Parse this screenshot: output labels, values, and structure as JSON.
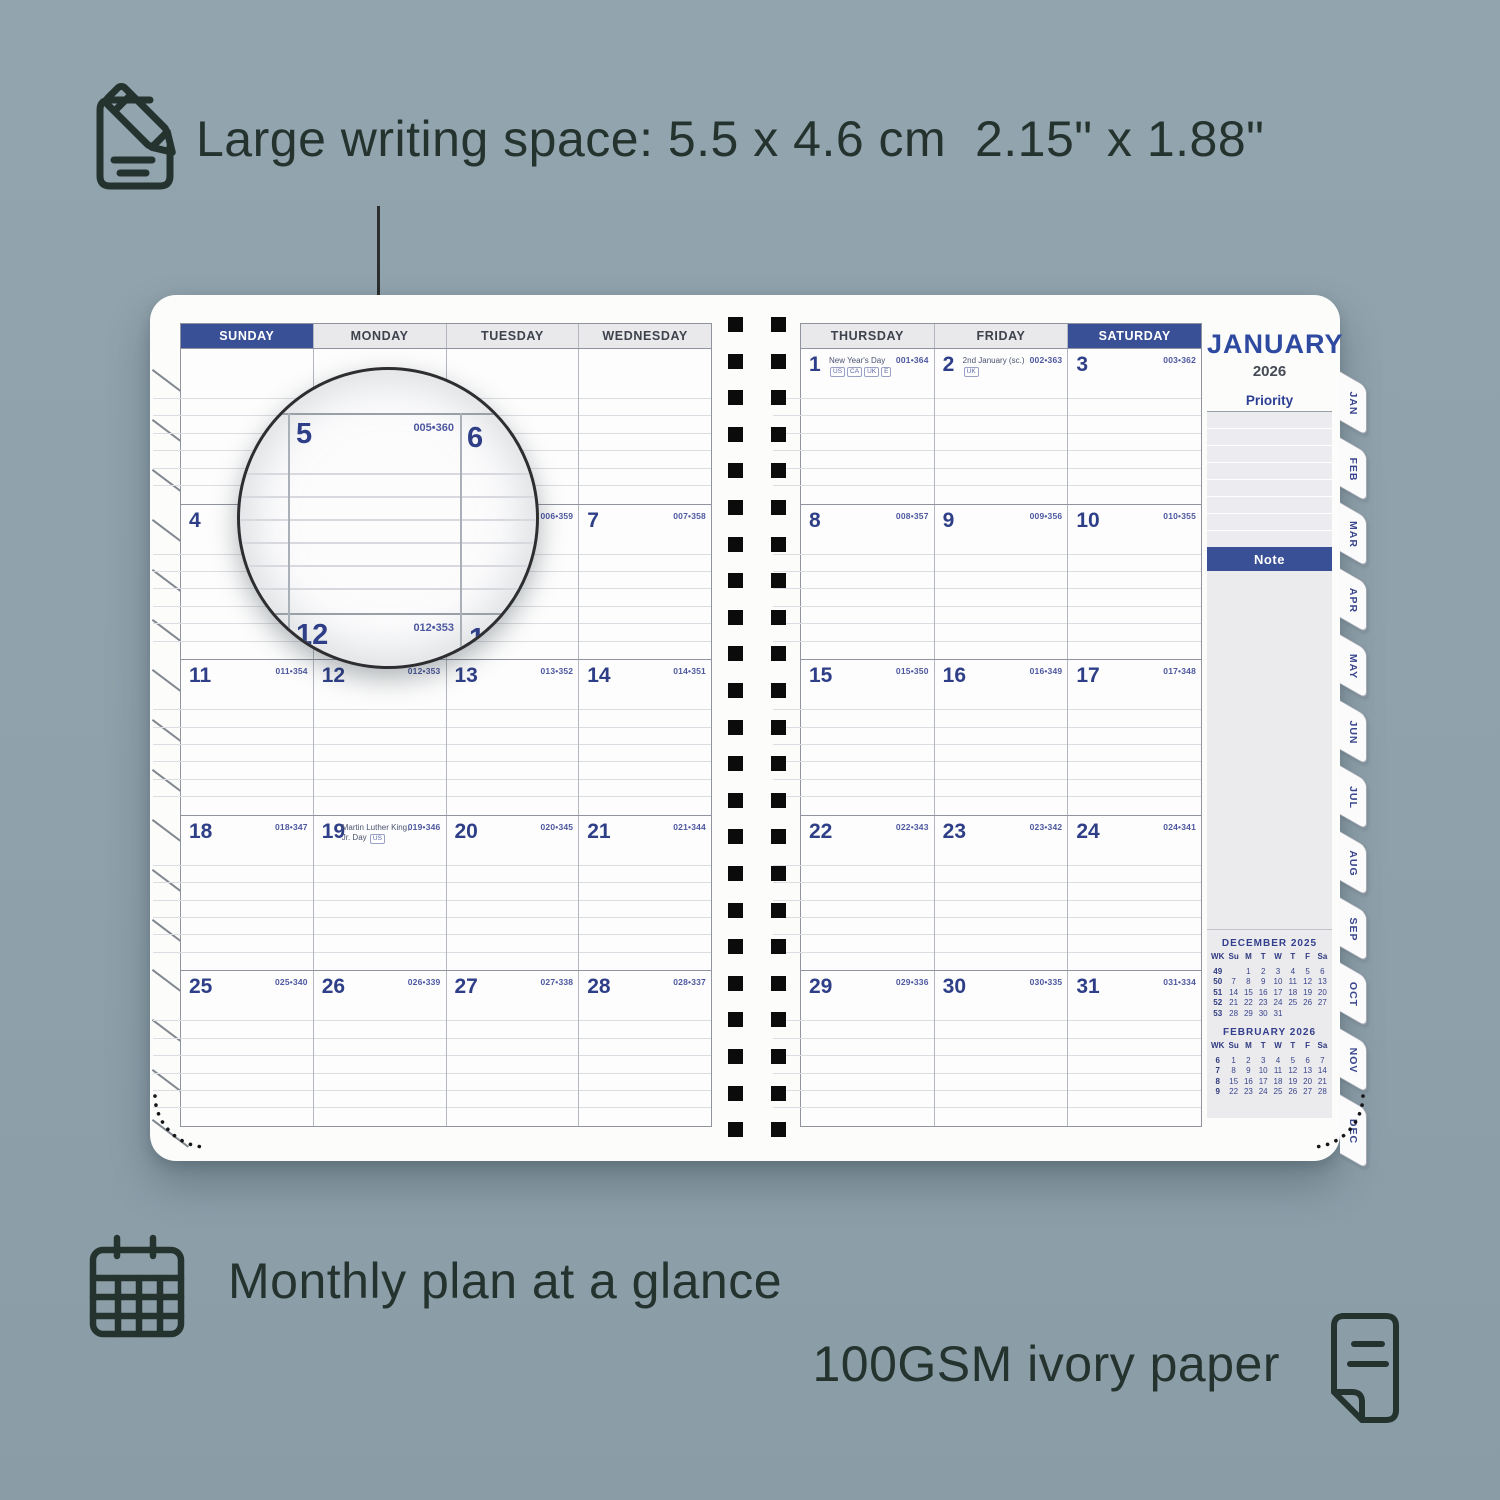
{
  "features": {
    "writing_space": "Large writing space: 5.5 x 4.6 cm  2.15\" x 1.88\"",
    "monthly_plan": "Monthly plan at a glance",
    "paper": "100GSM ivory paper"
  },
  "icons": {
    "top": "notepad-pencil-icon",
    "monthly": "calendar-grid-icon",
    "paper": "paper-sheet-icon"
  },
  "colors": {
    "background": "#8fa1ab",
    "ink": "#25332f",
    "planner_blue": "#3a5096",
    "day_number_blue": "#2e3f88",
    "code_blue": "#4d58a0",
    "header_gray": "#e9e9eb",
    "panel_gray": "#ebebee"
  },
  "planner": {
    "month": "JANUARY",
    "year": "2026",
    "left_headers": [
      "SUNDAY",
      "MONDAY",
      "TUESDAY",
      "WEDNESDAY"
    ],
    "right_headers": [
      "THURSDAY",
      "FRIDAY",
      "SATURDAY"
    ],
    "priority_label": "Priority",
    "note_label": "Note",
    "tabs": [
      "JAN",
      "FEB",
      "MAR",
      "APR",
      "MAY",
      "JUN",
      "JUL",
      "AUG",
      "SEP",
      "OCT",
      "NOV",
      "DEC"
    ],
    "weeks": [
      {
        "left": [
          null,
          null,
          null,
          null
        ],
        "right": [
          {
            "day": "1",
            "code": "001•364",
            "holiday": "New Year's Day",
            "badges": [
              "US",
              "CA",
              "UK",
              "E"
            ]
          },
          {
            "day": "2",
            "code": "002•363",
            "holiday": "2nd January (sc.)",
            "badges": [
              "UK"
            ]
          },
          {
            "day": "3",
            "code": "003•362"
          }
        ]
      },
      {
        "left": [
          {
            "day": "4",
            "code": "004•361"
          },
          {
            "day": "5",
            "code": "005•360"
          },
          {
            "day": "6",
            "code": "006•359"
          },
          {
            "day": "7",
            "code": "007•358"
          }
        ],
        "right": [
          {
            "day": "8",
            "code": "008•357"
          },
          {
            "day": "9",
            "code": "009•356"
          },
          {
            "day": "10",
            "code": "010•355"
          }
        ]
      },
      {
        "left": [
          {
            "day": "11",
            "code": "011•354"
          },
          {
            "day": "12",
            "code": "012•353"
          },
          {
            "day": "13",
            "code": "013•352"
          },
          {
            "day": "14",
            "code": "014•351"
          }
        ],
        "right": [
          {
            "day": "15",
            "code": "015•350"
          },
          {
            "day": "16",
            "code": "016•349"
          },
          {
            "day": "17",
            "code": "017•348"
          }
        ]
      },
      {
        "left": [
          {
            "day": "18",
            "code": "018•347"
          },
          {
            "day": "19",
            "code": "019•346",
            "holiday": "Martin Luther King, Jr. Day",
            "badges": [
              "US"
            ]
          },
          {
            "day": "20",
            "code": "020•345"
          },
          {
            "day": "21",
            "code": "021•344"
          }
        ],
        "right": [
          {
            "day": "22",
            "code": "022•343"
          },
          {
            "day": "23",
            "code": "023•342"
          },
          {
            "day": "24",
            "code": "024•341"
          }
        ]
      },
      {
        "left": [
          {
            "day": "25",
            "code": "025•340"
          },
          {
            "day": "26",
            "code": "026•339"
          },
          {
            "day": "27",
            "code": "027•338"
          },
          {
            "day": "28",
            "code": "028•337"
          }
        ],
        "right": [
          {
            "day": "29",
            "code": "029•336"
          },
          {
            "day": "30",
            "code": "030•335"
          },
          {
            "day": "31",
            "code": "031•334"
          }
        ]
      }
    ],
    "mini_calendars": [
      {
        "title": "DECEMBER  2025",
        "header": [
          "WK",
          "Su",
          "M",
          "T",
          "W",
          "T",
          "F",
          "Sa"
        ],
        "rows": [
          [
            "49",
            "",
            "1",
            "2",
            "3",
            "4",
            "5",
            "6"
          ],
          [
            "50",
            "7",
            "8",
            "9",
            "10",
            "11",
            "12",
            "13"
          ],
          [
            "51",
            "14",
            "15",
            "16",
            "17",
            "18",
            "19",
            "20"
          ],
          [
            "52",
            "21",
            "22",
            "23",
            "24",
            "25",
            "26",
            "27"
          ],
          [
            "53",
            "28",
            "29",
            "30",
            "31",
            "",
            "",
            ""
          ]
        ]
      },
      {
        "title": "FEBRUARY  2026",
        "header": [
          "WK",
          "Su",
          "M",
          "T",
          "W",
          "T",
          "F",
          "Sa"
        ],
        "rows": [
          [
            "6",
            "1",
            "2",
            "3",
            "4",
            "5",
            "6",
            "7"
          ],
          [
            "7",
            "8",
            "9",
            "10",
            "11",
            "12",
            "13",
            "14"
          ],
          [
            "8",
            "15",
            "16",
            "17",
            "18",
            "19",
            "20",
            "21"
          ],
          [
            "9",
            "22",
            "23",
            "24",
            "25",
            "26",
            "27",
            "28"
          ]
        ]
      }
    ]
  },
  "magnifier": {
    "day5": "5",
    "code5": "005•360",
    "day6": "6",
    "day12": "12",
    "code12": "012•353",
    "day13": "13"
  }
}
